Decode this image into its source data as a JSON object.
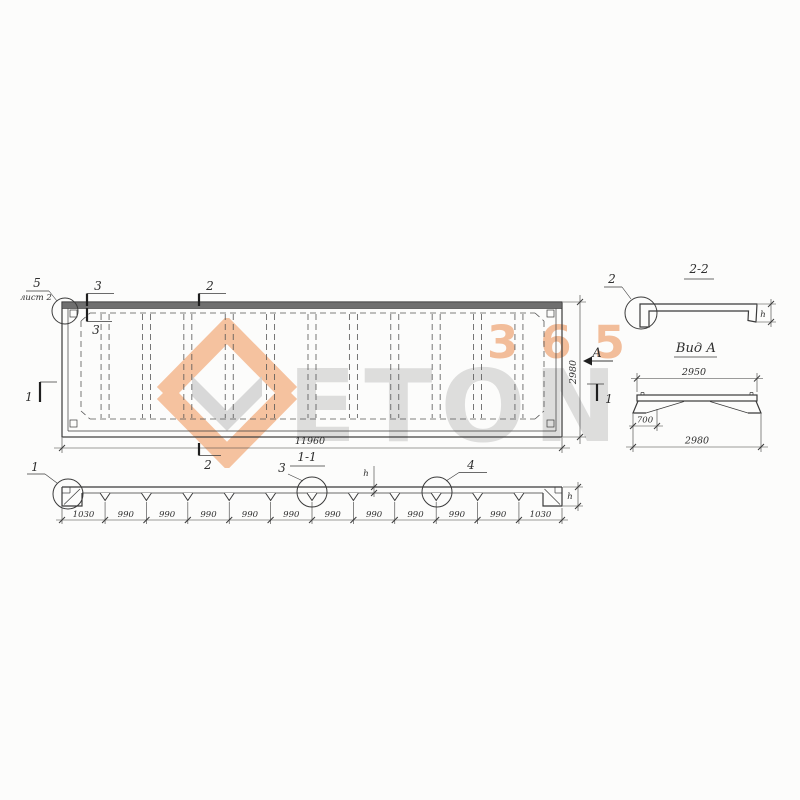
{
  "watermark": {
    "brand": "ETON",
    "number": "365"
  },
  "colors": {
    "ink": "#3a3a3a",
    "watermark_orange": "#ee8d4c",
    "watermark_gray": "#a9a9a9"
  },
  "plan": {
    "callout_5": "5",
    "callout_5_note": "лист 2",
    "marks": {
      "m1": "1",
      "m2": "2",
      "m3": "3"
    },
    "view_marker": "А",
    "dim_length": "11960",
    "dim_width": "2980"
  },
  "section_1_1": {
    "title": "1-1",
    "callout_1": "1",
    "callout_3": "3",
    "callout_4": "4",
    "dim_chain": [
      "1030",
      "990",
      "990",
      "990",
      "990",
      "990",
      "990",
      "990",
      "990",
      "990",
      "990",
      "1030"
    ],
    "flange_thickness_label": "h",
    "end_height_label": "h"
  },
  "section_2_2": {
    "title": "2-2",
    "callout_2": "2",
    "height_label": "h"
  },
  "view_a": {
    "title": "Вид А",
    "dim_top": "2950",
    "dim_leg_offset": "700",
    "dim_bottom": "2980"
  }
}
